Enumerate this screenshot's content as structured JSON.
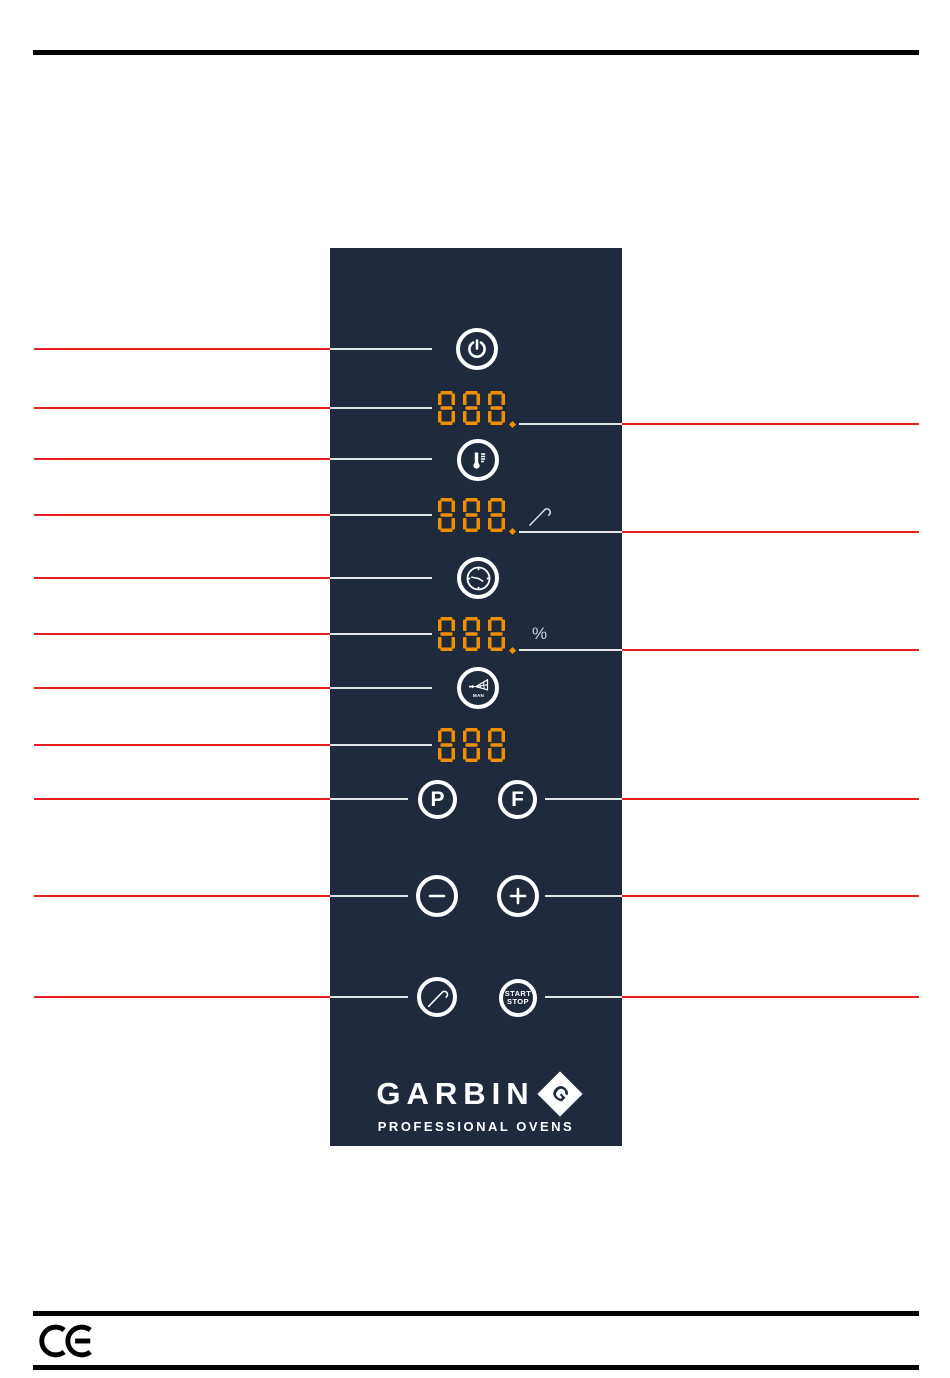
{
  "colors": {
    "panel_bg": "#1F2B3D",
    "segment_orange": "#F09000",
    "callout_red": "#E00000",
    "icon_white": "#FFFFFF",
    "rule_black": "#000000",
    "suffix_gray": "#CDD2D8"
  },
  "panel": {
    "displays": [
      {
        "value": "888",
        "decimal_point": true,
        "suffix": null,
        "suffix_icon": null
      },
      {
        "value": "888",
        "decimal_point": true,
        "suffix": null,
        "suffix_icon": "core-probe-icon"
      },
      {
        "value": "888",
        "decimal_point": true,
        "suffix": "%",
        "suffix_icon": null
      },
      {
        "value": "888",
        "decimal_point": false,
        "suffix": null,
        "suffix_icon": null
      }
    ],
    "buttons": {
      "power": {
        "icon": "power-icon"
      },
      "temperature": {
        "icon": "thermometer-icon"
      },
      "time": {
        "icon": "clock-icon"
      },
      "steam": {
        "icon": "steam-spray-icon",
        "label": "MAN"
      },
      "program": {
        "label": "P"
      },
      "function": {
        "label": "F"
      },
      "decrease": {
        "icon": "minus-icon"
      },
      "increase": {
        "icon": "plus-icon"
      },
      "core_probe": {
        "icon": "core-probe-icon"
      },
      "start_stop": {
        "label_top": "START",
        "label_bottom": "STOP"
      }
    },
    "logo": {
      "brand": "GARBIN",
      "monogram": "G",
      "tagline": "PROFESSIONAL OVENS"
    }
  },
  "footer": {
    "certification": "CE"
  }
}
